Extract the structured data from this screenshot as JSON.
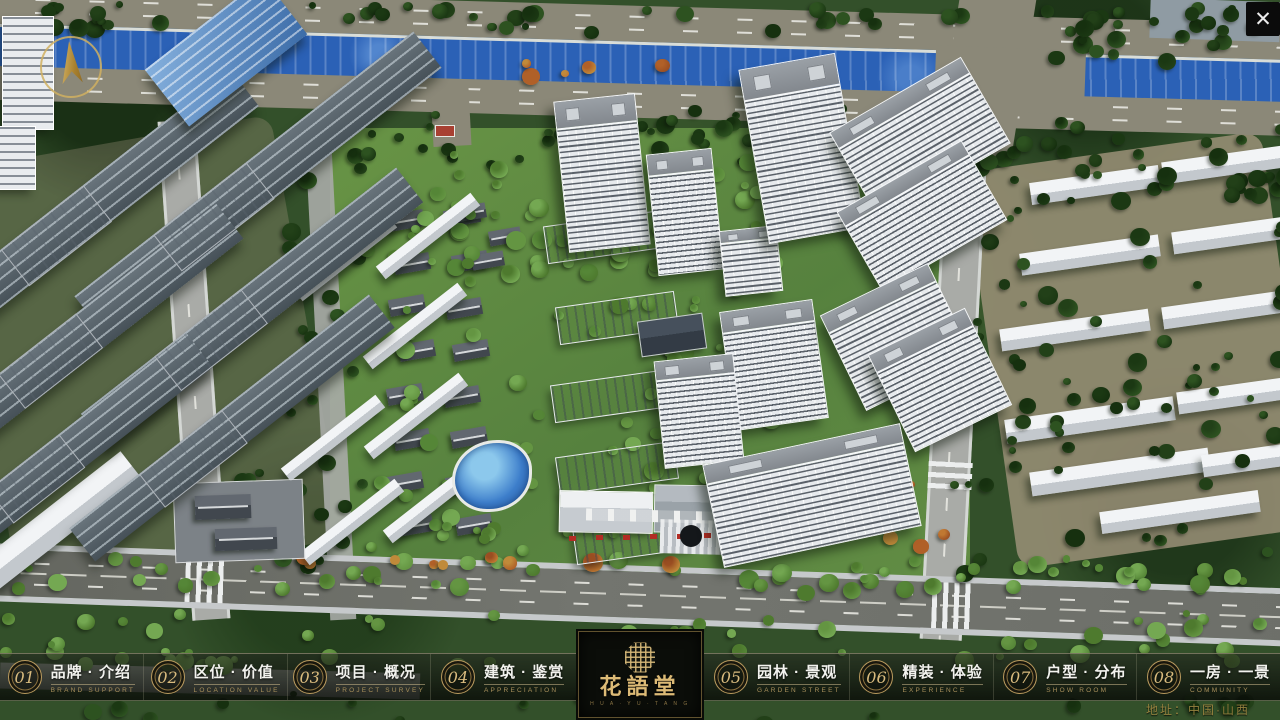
{
  "app": {
    "logo": {
      "name": "花語堂",
      "subtitle": "H U A · Y U · T A N G"
    },
    "address": "地址：中国·山西"
  },
  "controls": {
    "close": "✕"
  },
  "navbar": {
    "items": [
      {
        "num": "01",
        "zh": "品牌 · 介绍",
        "en": "BRAND SUPPORT"
      },
      {
        "num": "02",
        "zh": "区位 · 价值",
        "en": "LOCATION VALUE"
      },
      {
        "num": "03",
        "zh": "项目 · 概况",
        "en": "PROJECT SURVEY"
      },
      {
        "num": "04",
        "zh": "建筑 · 鉴赏",
        "en": "APPRECIATION"
      },
      {
        "num": "05",
        "zh": "园林 · 景观",
        "en": "GARDEN STREET"
      },
      {
        "num": "06",
        "zh": "精装 · 体验",
        "en": "EXPERIENCE"
      },
      {
        "num": "07",
        "zh": "户型 · 分布",
        "en": "SHOW ROOM"
      },
      {
        "num": "08",
        "zh": "一房 · 一景",
        "en": "COMMUNITY"
      }
    ]
  },
  "colors": {
    "accent_gold": "#c8a868",
    "bar_background": "rgba(10,12,8,0.75)",
    "river_blue": "#2b61b6",
    "foliage_green": "#2e4a22",
    "building_white": "#e9ecef"
  }
}
